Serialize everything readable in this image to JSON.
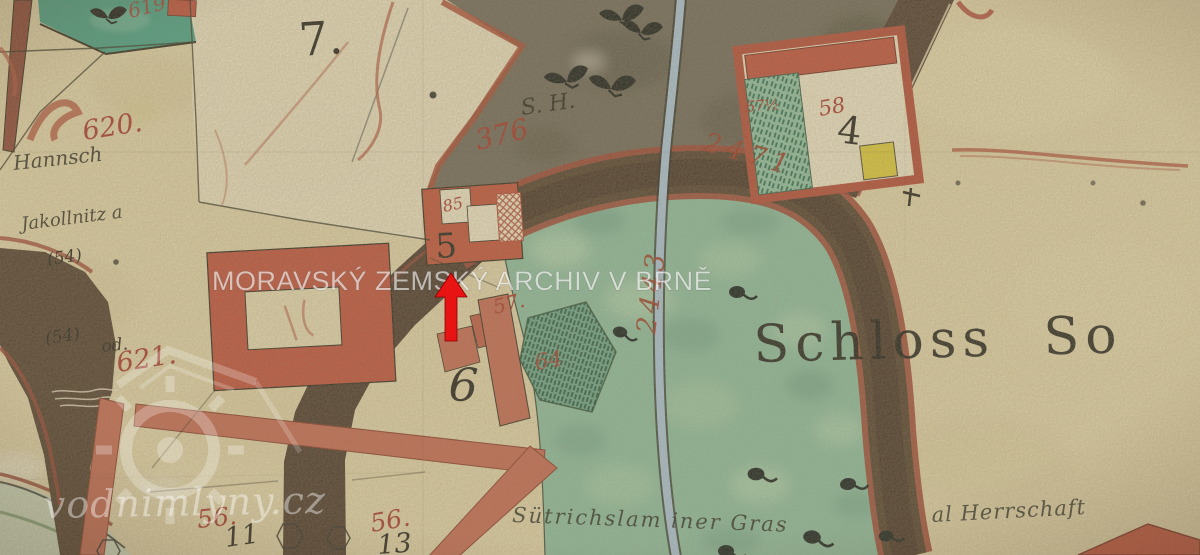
{
  "watermarks": {
    "archive": "MORAVSKÝ ZEMSKÝ ARCHIV V BRNĚ",
    "website": "vodnimlyny.cz"
  },
  "labels": {
    "schloss": "Schloss So",
    "parcel_7": "7.",
    "parcel_619": "619",
    "parcel_620": "620.",
    "parcel_621": "621.",
    "parcel_376": "376",
    "parcel_6": "6",
    "parcel_64": "64",
    "parcel_56_left": "56.",
    "parcel_56_right": "56.",
    "house_11": "11",
    "house_13": "13",
    "house_5": "5",
    "house_85": "85",
    "house_57": "57.",
    "house_58": "58",
    "house_4": "4",
    "house_67half": "67½",
    "road_2471": "2471",
    "stream_2443": "2443",
    "note_54_upper": "(54)",
    "note_54_lower": "(54)",
    "note_od": "od.",
    "script_owner_1": "Hannsch",
    "script_owner_2": "Jakollnitz a",
    "script_sh": "S. H.",
    "script_pond_left": "Sütrichslam iner Gras",
    "script_pond_right": "al Herrschaft"
  },
  "colors": {
    "paper": "#e0d3a6",
    "pond_green": "#8abb9c",
    "road_dark_brown": "#4d3927",
    "road_red": "#c4684f",
    "building_red": "#bf4f38",
    "stream_blue": "#a9c2d3",
    "olive_field": "#6e6856",
    "label_red": "#a8392b",
    "arrow_red": "#e81313"
  }
}
